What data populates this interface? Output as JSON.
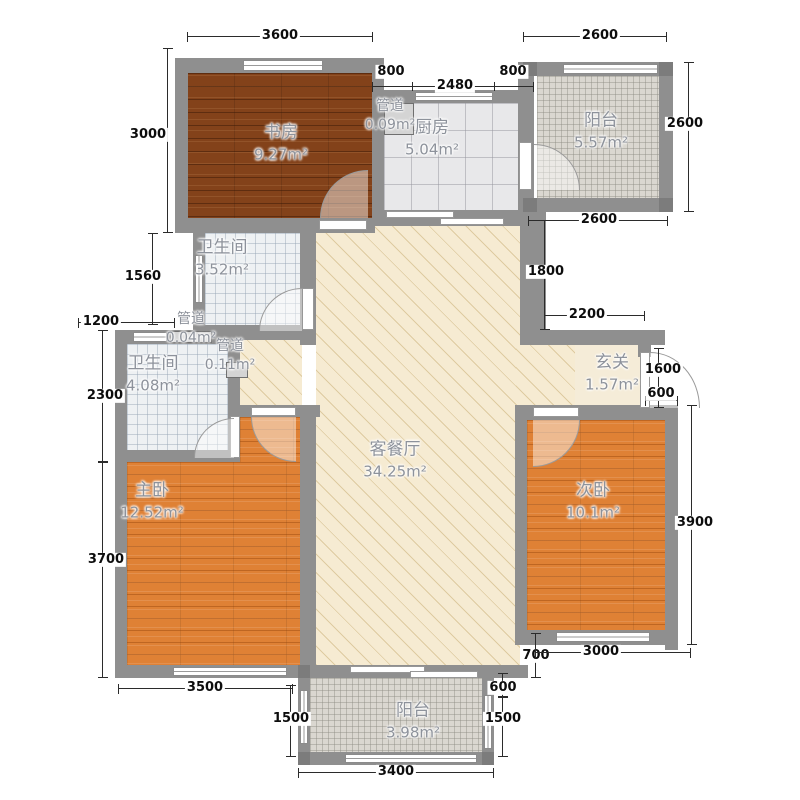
{
  "palette": {
    "wall": "#8f8f8f",
    "dark_wood": "#83421a",
    "orange_wood": "#df8135",
    "kitchen_tile": "#e8e8ea",
    "balcony_mosaic": "#dad7d0",
    "bath_tile": "#eef1f3",
    "living_cream": "#f6ebd2",
    "dim_text": "#0d0d0d",
    "room_label": "#8d929b"
  },
  "rooms": {
    "study": {
      "name": "书房",
      "area": "9.27m²"
    },
    "pipe_top": {
      "name": "管道",
      "area": "0.09m²"
    },
    "kitchen": {
      "name": "厨房",
      "area": "5.04m²"
    },
    "balcony_top": {
      "name": "阳台",
      "area": "5.57m²"
    },
    "bath_small": {
      "name": "卫生间",
      "area": "3.52m²"
    },
    "pipe_mid": {
      "name": "管道",
      "area": "0.04m²"
    },
    "pipe_low": {
      "name": "管道",
      "area": "0.11m²"
    },
    "bath_main": {
      "name": "卫生间",
      "area": "4.08m²"
    },
    "master": {
      "name": "主卧",
      "area": "12.52m²"
    },
    "living": {
      "name": "客餐厅",
      "area": "34.25m²"
    },
    "entry": {
      "name": "玄关",
      "area": "1.57m²"
    },
    "second": {
      "name": "次卧",
      "area": "10.1m²"
    },
    "balcony_bottom": {
      "name": "阳台",
      "area": "3.98m²"
    }
  },
  "dims": {
    "top_study": "3600",
    "top_balcony": "2600",
    "shaft_w": "800",
    "kitchen_w": "2480",
    "kitchen_r": "800",
    "study_h": "3000",
    "bath1_h": "1560",
    "pipe_w": "1200",
    "bath2_h": "2300",
    "master_h": "3700",
    "master_w": "3500",
    "balcony_b_left": "1500",
    "balcony_b_w": "3400",
    "balcony_b_right": "1500",
    "step_600r": "600",
    "step_700": "700",
    "second_w": "3000",
    "second_h": "3900",
    "balcony_t_h": "2600",
    "balcony_t_under": "2600",
    "recess_h": "1800",
    "entry_top_w": "2200",
    "entry_door": "1600",
    "entry_step": "600"
  }
}
